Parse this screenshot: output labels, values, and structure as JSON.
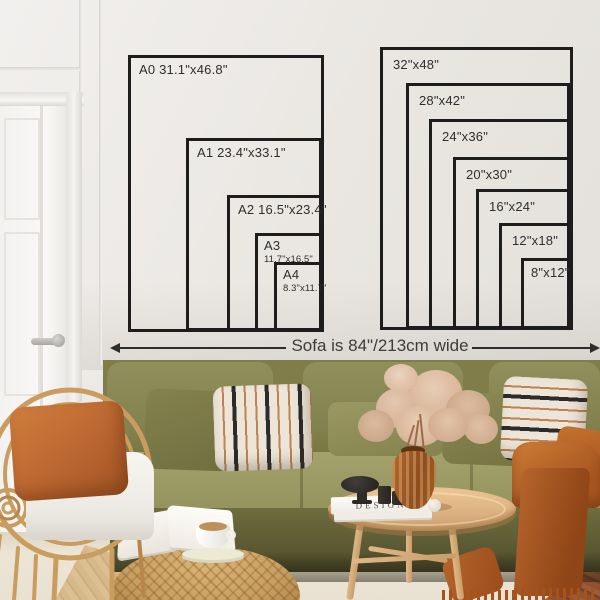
{
  "caption": {
    "text": "Sofa is 84\"/213cm wide"
  },
  "size_chart_a": {
    "boxes": [
      {
        "series": "A0",
        "line1": "A0 31.1\"x46.8\"",
        "line2": ""
      },
      {
        "series": "A1",
        "line1": "A1 23.4\"x33.1\"",
        "line2": ""
      },
      {
        "series": "A2",
        "line1": "A2 16.5\"x23.4\"",
        "line2": ""
      },
      {
        "series": "A3",
        "line1": "A3",
        "line2": "11.7\"x16.5\""
      },
      {
        "series": "A4",
        "line1": "A4",
        "line2": "8.3\"x11.7\""
      }
    ]
  },
  "size_chart_inch": {
    "boxes": [
      {
        "line1": "32\"x48\""
      },
      {
        "line1": "28\"x42\""
      },
      {
        "line1": "24\"x36\""
      },
      {
        "line1": "20\"x30\""
      },
      {
        "line1": "16\"x24\""
      },
      {
        "line1": "12\"x18\""
      },
      {
        "line1": "8\"x12\""
      }
    ]
  },
  "decor": {
    "coffee_table_book_title": "DESIGN"
  },
  "palette": {
    "wall": "#eae7e3",
    "chart_line": "#1d1d1d",
    "label_text": "#2e2e2e",
    "sofa_olive": "#8d8c57",
    "sofa_base": "#6d6c3d",
    "pillow_stripe_bg": "#ece5d8",
    "pillow_stripe_dark": "#2b2b2b",
    "pillow_stripe_rust": "#bc8354",
    "pillow_orange": "#c06a33",
    "blanket_rust": "#b35c26",
    "rattan": "#c99c5f",
    "pouf": "#c89d60",
    "table_wood": "#ddb283",
    "rug": "#e9e1d1",
    "floor_right_wood": "#8a4e2d",
    "floor_left_wood": "#d9bd92",
    "vase_amber": "#a35d22",
    "dried_flowers": "#d8b69a"
  }
}
